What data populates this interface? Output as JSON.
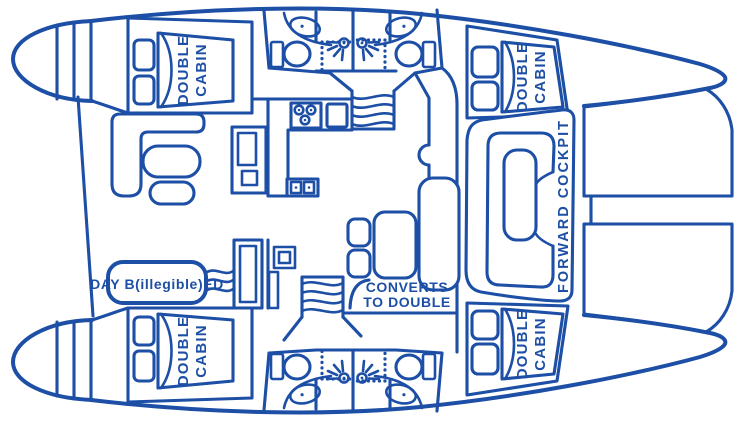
{
  "colors": {
    "line": "#1c4fa5",
    "background": "#ffffff"
  },
  "diagram": {
    "type": "catamaran-floor-plan",
    "labels": {
      "cabins": [
        {
          "position": "aft-port",
          "line1": "DOUBLE",
          "line2": "CABIN"
        },
        {
          "position": "forward-port",
          "line1": "DOUBLE",
          "line2": "CABIN"
        },
        {
          "position": "aft-starboard",
          "line1": "DOUBLE",
          "line2": "CABIN"
        },
        {
          "position": "forward-starboard",
          "line1": "DOUBLE",
          "line2": "CABIN"
        }
      ],
      "day_bed": "DAY B(illegible)ED",
      "dinette": {
        "line1": "CONVERTS",
        "line2": "TO DOUBLE"
      },
      "forward_cockpit": "FORWARD COCKPIT"
    },
    "icons": [
      "toilet",
      "sink",
      "shower-head",
      "stove-burners",
      "stairs-waves",
      "trampoline-mesh"
    ]
  }
}
